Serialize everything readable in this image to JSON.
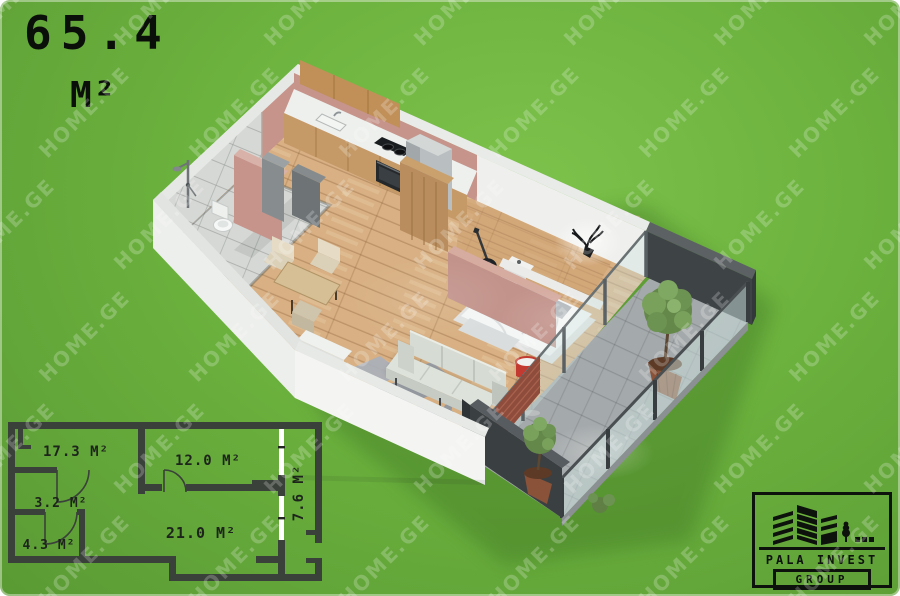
{
  "area_label": {
    "value": "65.4",
    "unit": "M²"
  },
  "watermark": {
    "text": "HOME.GE"
  },
  "floor_plan_2d": {
    "rooms": [
      {
        "id": "room-kitchen-living",
        "label": "17.3 M²"
      },
      {
        "id": "room-bedroom",
        "label": "12.0 M²"
      },
      {
        "id": "room-hall",
        "label": "3.2 M²"
      },
      {
        "id": "room-bathroom",
        "label": "4.3 M²"
      },
      {
        "id": "room-living",
        "label": "21.0 M²"
      },
      {
        "id": "room-balcony",
        "label": "7.6 M²"
      }
    ]
  },
  "logo": {
    "company_line1": "PALA INVEST",
    "company_line2": "GROUP"
  },
  "colors": {
    "background_green": "#6cb23e",
    "plan_wall_dark": "#3a403a",
    "label_black": "#10150e",
    "watermark_white": "#ffffff",
    "logo_black": "#0d120c",
    "interior_pink_wall": "#c6948b",
    "wood_floor": "#d8b083",
    "balcony_dark_wall": "#3e4346"
  }
}
